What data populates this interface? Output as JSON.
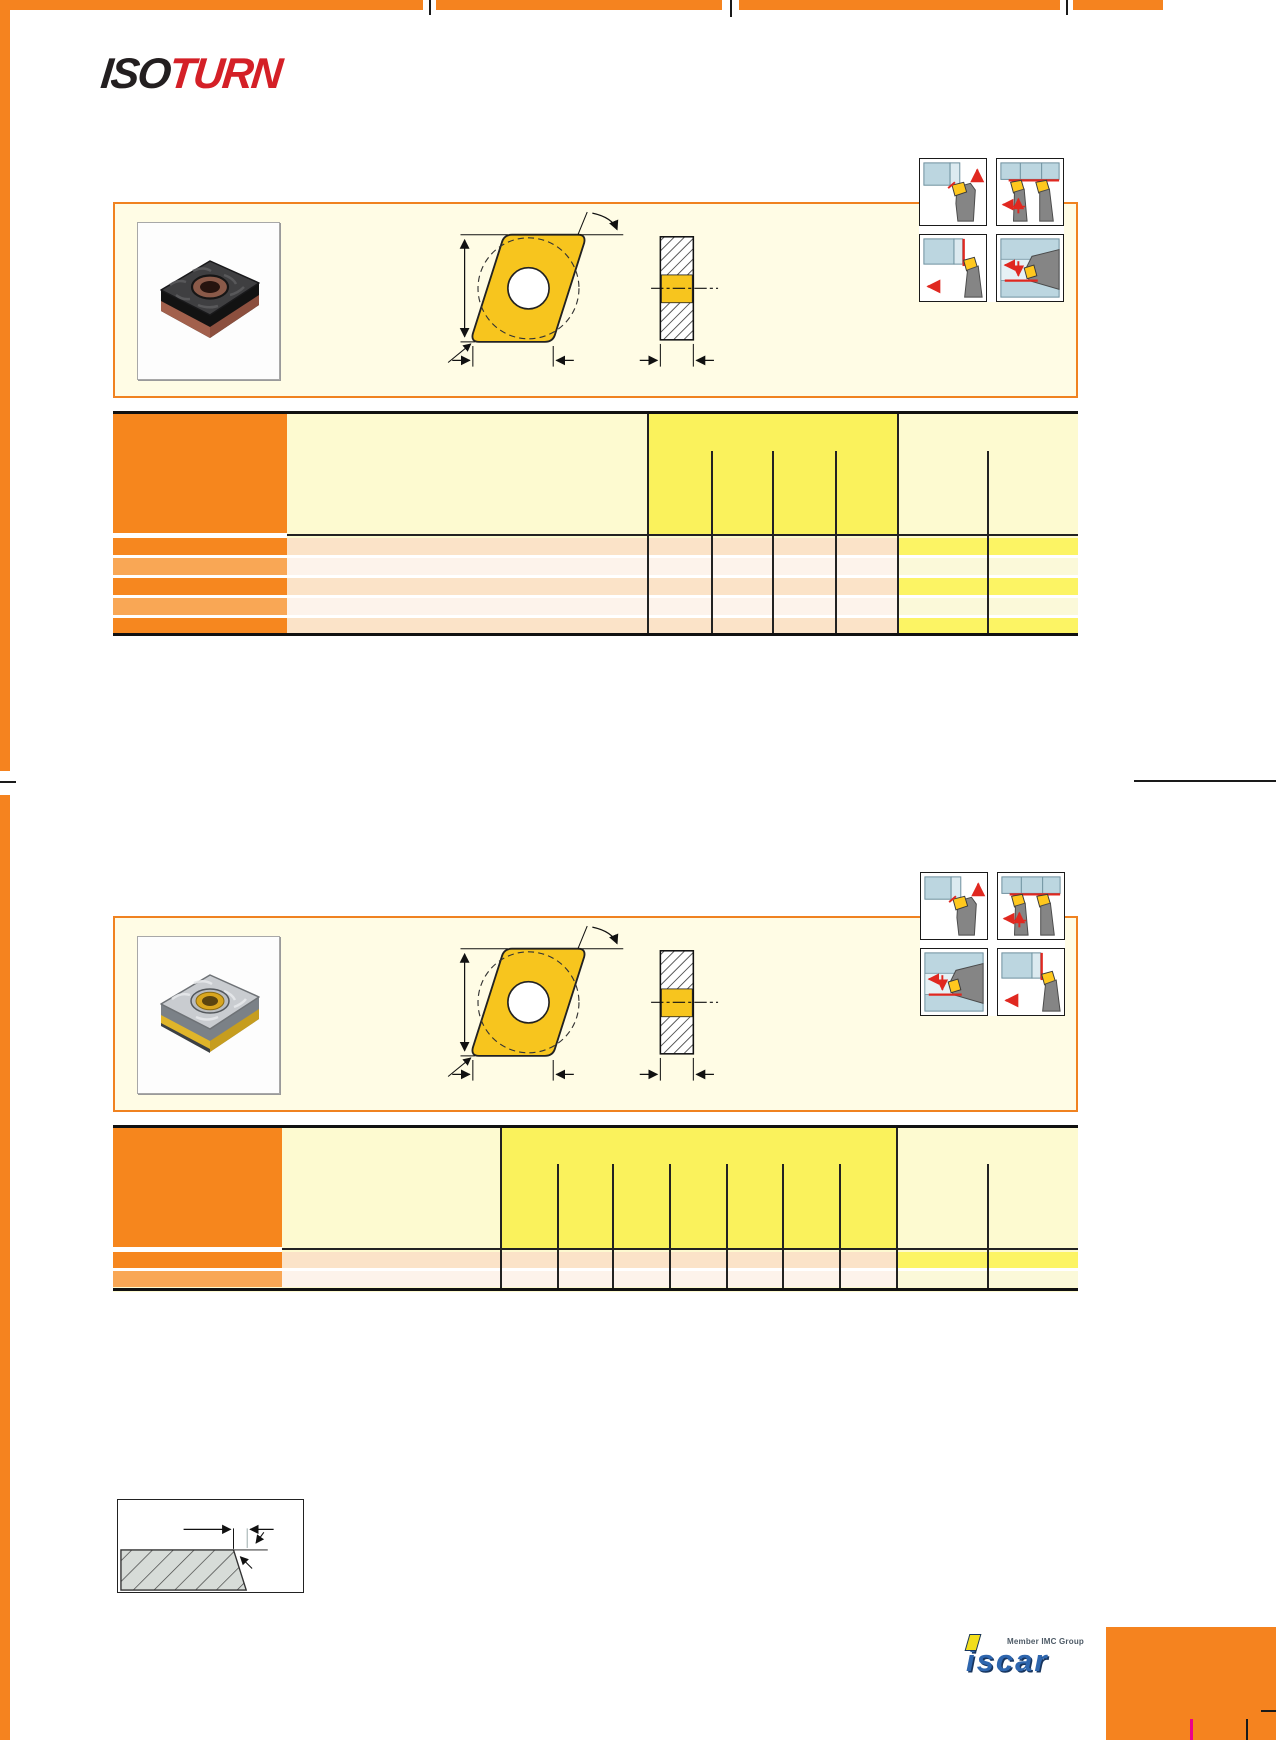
{
  "page": {
    "width": 1276,
    "height": 1740,
    "background": "#ffffff",
    "kind": "catalog-page-scan"
  },
  "colors": {
    "page_accent": "#F5831F",
    "box_border": "#F08220",
    "box_bg": "#FFFCE5",
    "table_bg": "#FDFAD0",
    "yellow_block": "#FAF25C",
    "header_cell_orange": "#F6861D",
    "row_orange": "#F6871F",
    "row_orange_light": "#F9A755",
    "row_peach": "#FBE3C8",
    "row_white": "#FDF3EB",
    "row_yellow": "#FCF464",
    "row_yellow_pale": "#FBF9D9",
    "insert_yellow": "#F7C51E",
    "icon_blue": "#BCD6E0",
    "icon_blue_light": "#DCEAF0",
    "icon_gray": "#8A8A8A",
    "signal_red": "#E02820",
    "magenta": "#EC008C",
    "iso_black": "#231F20",
    "turn_red": "#D42027",
    "iscar_blue": "#2E66AE",
    "iscar_yellow": "#F2DE1C"
  },
  "logo": {
    "part1": "ISO",
    "part2": "TURN"
  },
  "sections": [
    {
      "id": "section-1",
      "photo_icon": "black-insert-with-copper-layers-photo",
      "drawing_icon": "rhombic-insert-front-and-side-view-drawing",
      "app_icons": [
        "external-turning-up",
        "double-tool-turning",
        "facing-left",
        "internal-boring"
      ],
      "table": {
        "data_rows": 5,
        "yellow_group_subcolumns": 4,
        "right_group_subcolumns": 2,
        "cells_text": ""
      }
    },
    {
      "id": "section-2",
      "photo_icon": "silver-insert-with-yellow-bore-photo",
      "drawing_icon": "rhombic-insert-front-and-side-view-drawing",
      "app_icons": [
        "external-turning-up",
        "double-tool-turning",
        "internal-profiling",
        "external-facing-left"
      ],
      "table": {
        "data_rows": 2,
        "yellow_group_subcolumns": 7,
        "right_group_subcolumns": 2,
        "cells_text": ""
      }
    }
  ],
  "diagram": {
    "icon": "chamfer-width-and-angle-dimension-diagram"
  },
  "footer": {
    "member_text": "Member IMC Group",
    "brand_word": "iscar"
  }
}
